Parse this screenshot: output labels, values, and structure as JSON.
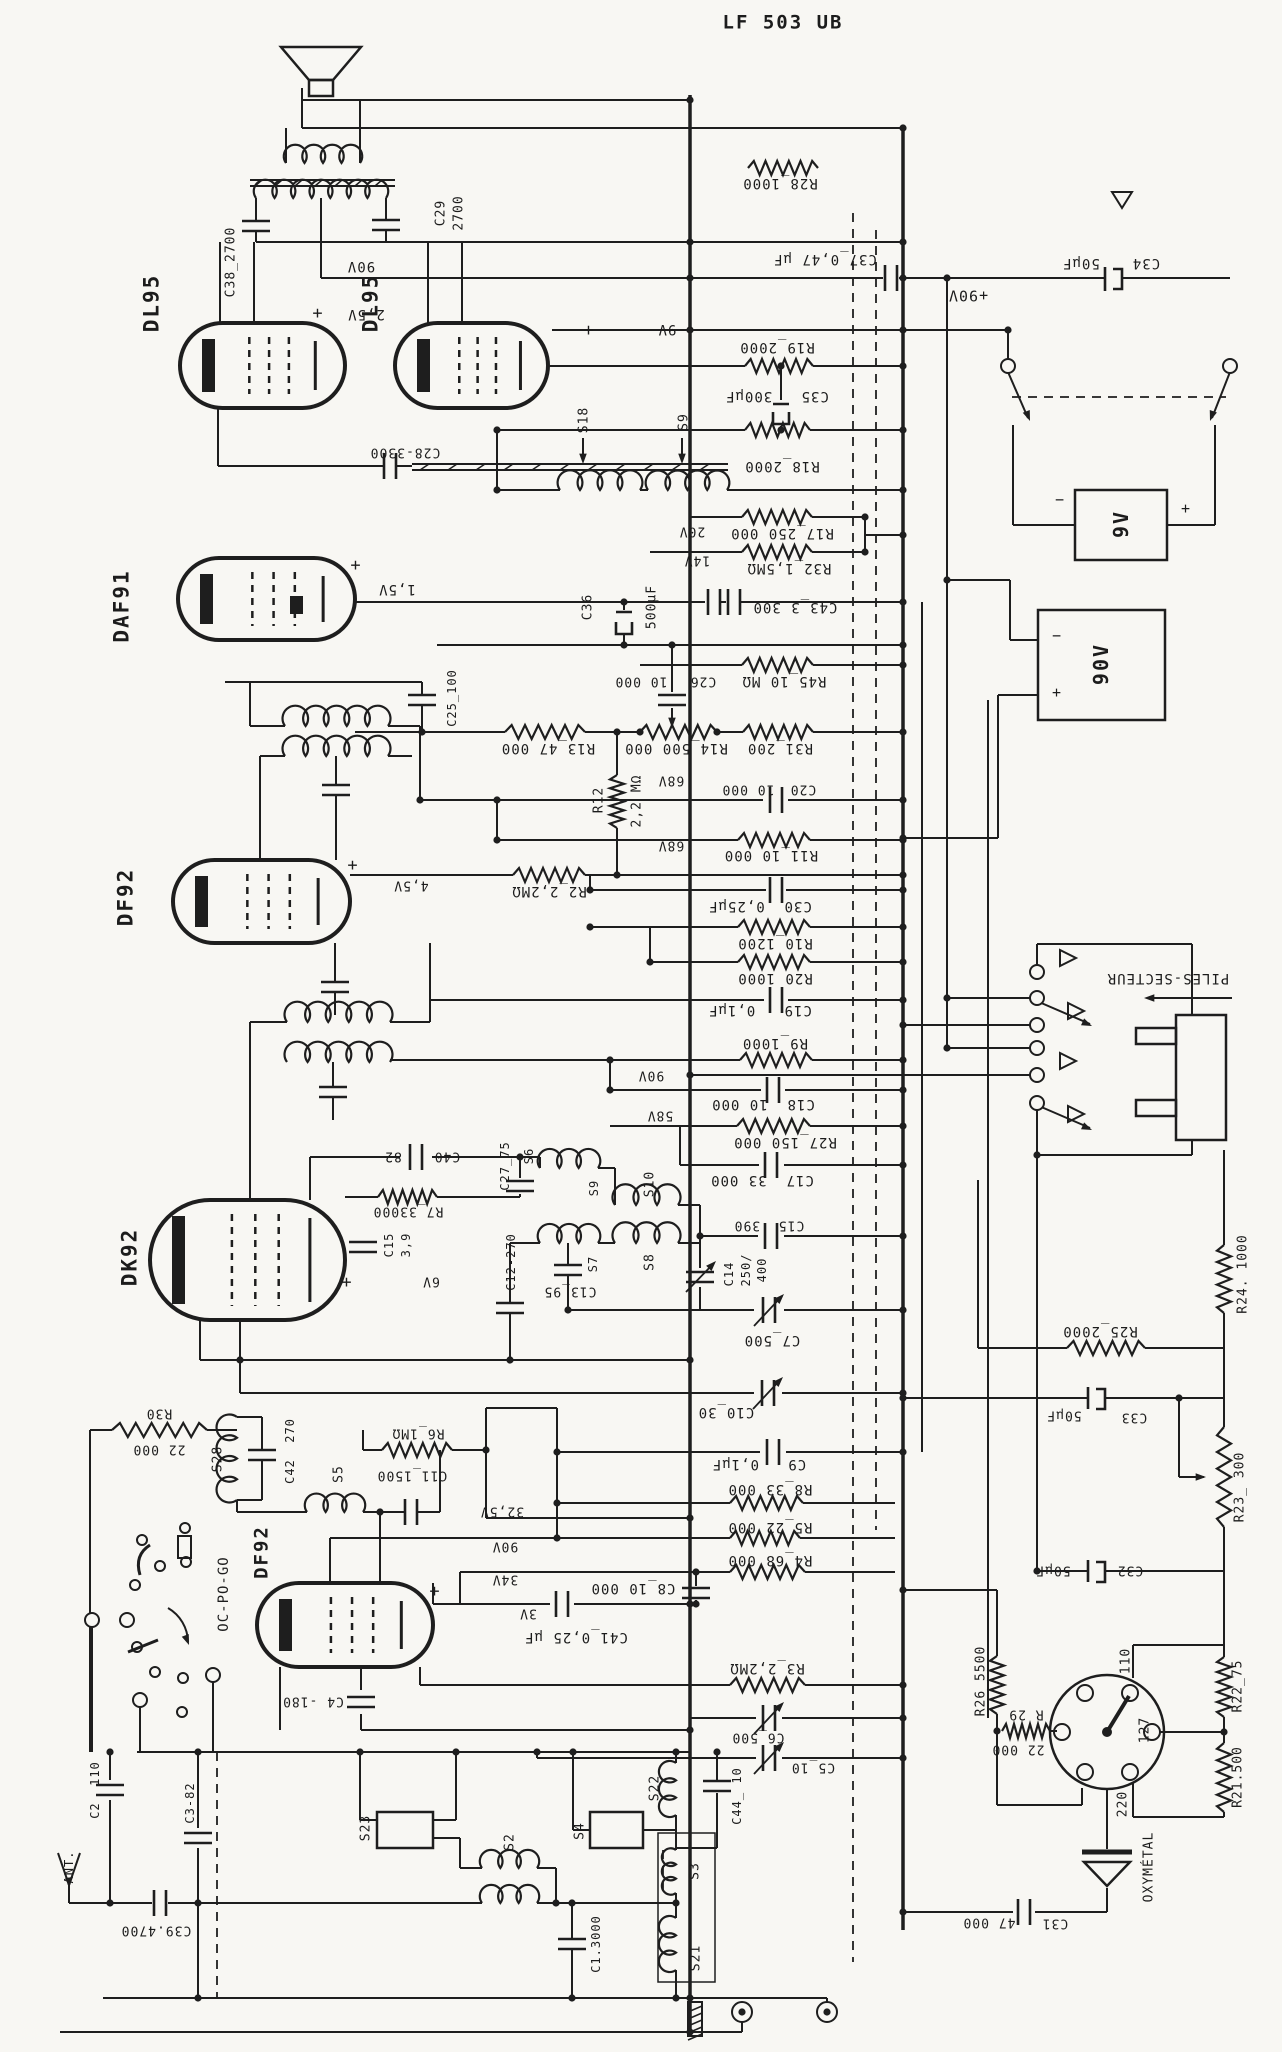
{
  "title": "LF 503 UB",
  "labels": {
    "title": "LF 503 UB",
    "dl95a": "DL95",
    "dl95b": "DL95",
    "daf91": "DAF91",
    "df92a": "DF92",
    "dk92": "DK92",
    "df92b": "DF92",
    "c38": "C38_2700",
    "c29a": "C29",
    "c29b": "2700",
    "v90top": "90V",
    "v25": "2,5V",
    "v9": "9V",
    "p1": "+",
    "p2": "+",
    "p3": "+",
    "p4": "+",
    "p5": "+",
    "p6": "+",
    "r28": "R28_1000",
    "c37": "C37_0,47 µF",
    "v90p": "+90V",
    "c34a": "50µF",
    "c34b": "C34",
    "r19": "R19_2000",
    "c35": "C35   300µF",
    "s18": "S18",
    "s9t": "S9",
    "r18": "R18_2000",
    "v20": "20V",
    "r17": "R17_250 000",
    "v14": "14V",
    "r32": "R32_1,5MΩ",
    "c36a": "C36",
    "c36b": "500µF",
    "c43": "C43_3 300",
    "c28": "C28-3300",
    "v15": "1,5V",
    "c25": "C25_100",
    "r45": "R45_10 MΩ",
    "c26a": "10 000",
    "c26b": "C26",
    "r31": "R31_200",
    "r14": "R14_500 000",
    "r13": "R13_47 000",
    "r12a": "R12",
    "r12b": "2,2 MΩ",
    "v68a": "68V",
    "v68b": "68V",
    "c20a": "10 000",
    "c20b": "C20",
    "r11": "R11_10 000",
    "r2": "R2_2,2MΩ",
    "v45": "4,5V",
    "c30": "C30  0,25µF",
    "r10": "R10_1200",
    "r20": "R20 1000",
    "c19": "C19   0,1µF",
    "r9": "R9_1000",
    "v90m": "90V",
    "c18": "C18  10 000",
    "v58": "58V",
    "r27": "R27_150 000",
    "c17": "C17  33 000",
    "s6": "S6",
    "s9m": "S9",
    "s10": "S10",
    "s8": "S8",
    "s7": "S7",
    "c27": "C27_75",
    "c40a": "82",
    "c40b": "C40",
    "r7": "R7_33000",
    "c15xa": "C15",
    "c15xb": "3,9",
    "v6": "6V",
    "c12": "C12-270",
    "c13": "C13_95",
    "c15": "C15  390",
    "c14a": "C14",
    "c14b": "250/",
    "c14c": "400",
    "c7": "C7_500",
    "c10": "C10_30",
    "c9": "C9   0,1µF",
    "r8": "R8_33 000",
    "r5": "R5_22 000",
    "r4": "R4_68 000",
    "c8": "C8_10 000",
    "v325": "32,5V",
    "v90b": "90V",
    "v34": "34V",
    "v3": "3V",
    "c41": "C41_0,25 µF",
    "r3": "R3_2,2MΩ",
    "c6": "C6_500",
    "c5": "C5_10",
    "c4": "C4 -180",
    "r30a": "R30",
    "r30b": "22 000",
    "s28": "S28",
    "c42": "C42  270",
    "s5": "S5",
    "c11": "C11_1500",
    "r6": "R6_1MΩ",
    "ocpogo": "OC-PO-GO",
    "c2": "C2  110",
    "c3": "C3-82",
    "ant": "ANT.",
    "c39": "C39.4700",
    "s23": "S23",
    "s2": "S2",
    "s4": "S4",
    "s22": "S22",
    "s3": "S3",
    "s21": "S21",
    "c44": "C44_ 10",
    "c1": "C1.3000",
    "r26": "R26_5500",
    "r29a": "R 29",
    "r29b": "22 000",
    "c31a": "47 000",
    "c31b": "C31",
    "c32a": "50µF",
    "c32b": "C32",
    "c33a": "50µF",
    "c33b": "C33",
    "r25": "R25_2000",
    "r24": "R24. 1000",
    "r23": "R23_ 300",
    "r22": "R22_75",
    "r21": "R21.500",
    "v110": "110",
    "v127": "127",
    "v220": "220",
    "oxy": "OXYMÉTAL",
    "piles": "PILES-SECTEUR",
    "bat9": "9V",
    "bat90": "90V",
    "bm9": "−",
    "bp9": "+",
    "bm90": "−",
    "bp90": "+"
  }
}
